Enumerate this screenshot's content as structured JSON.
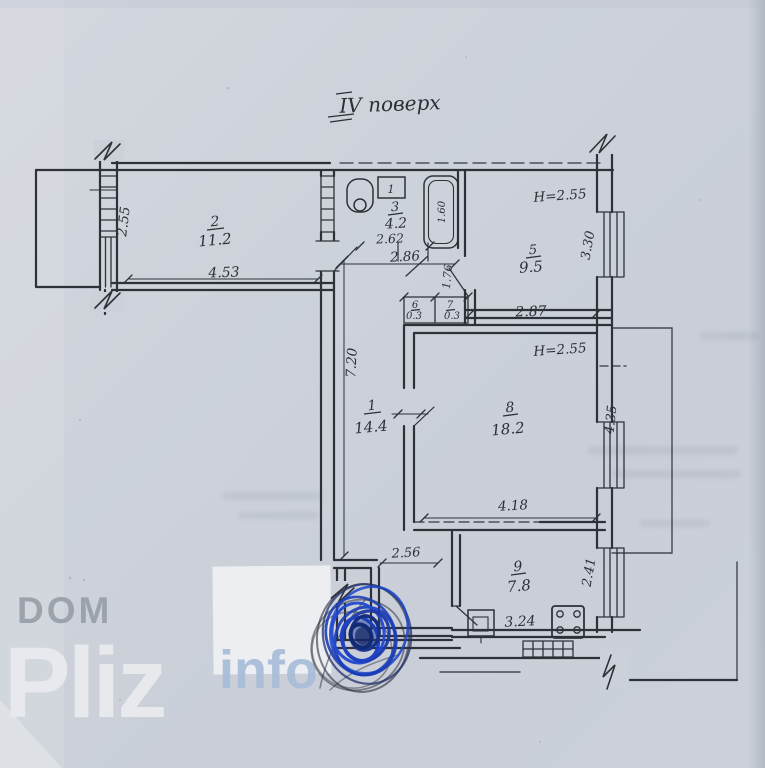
{
  "document": {
    "title": "IV поверх"
  },
  "watermark": {
    "dom": "DOM",
    "pliz": "Pliz",
    "info": "info"
  },
  "rooms": {
    "r1": {
      "num": "1",
      "area": "14.4"
    },
    "r2": {
      "num": "2",
      "area": "11.2"
    },
    "r3": {
      "num": "3",
      "area": "4.2"
    },
    "r5": {
      "num": "5",
      "area": "9.5"
    },
    "r6": {
      "num": "6",
      "area": "0.3"
    },
    "r7": {
      "num": "7",
      "area": "0.3"
    },
    "r8": {
      "num": "8",
      "area": "18.2"
    },
    "r9": {
      "num": "9",
      "area": "7.8"
    }
  },
  "dims": {
    "balcony_left_width": "2.55",
    "room2_width": "4.53",
    "bath_width": "2.62",
    "hall_top_width": "2.86",
    "bathtub_length": "1.60",
    "room5_height_note": "H=2.55",
    "room5_window": "3.30",
    "room5_width": "2.87",
    "passage_width": "1.76",
    "hall_length": "7.20",
    "room8_height_note": "H=2.55",
    "room8_window": "4.35",
    "room8_width": "4.18",
    "entry_width": "2.56",
    "kitchen_width": "3.24",
    "kitchen_window": "2.41",
    "fixture_mark": "1"
  }
}
